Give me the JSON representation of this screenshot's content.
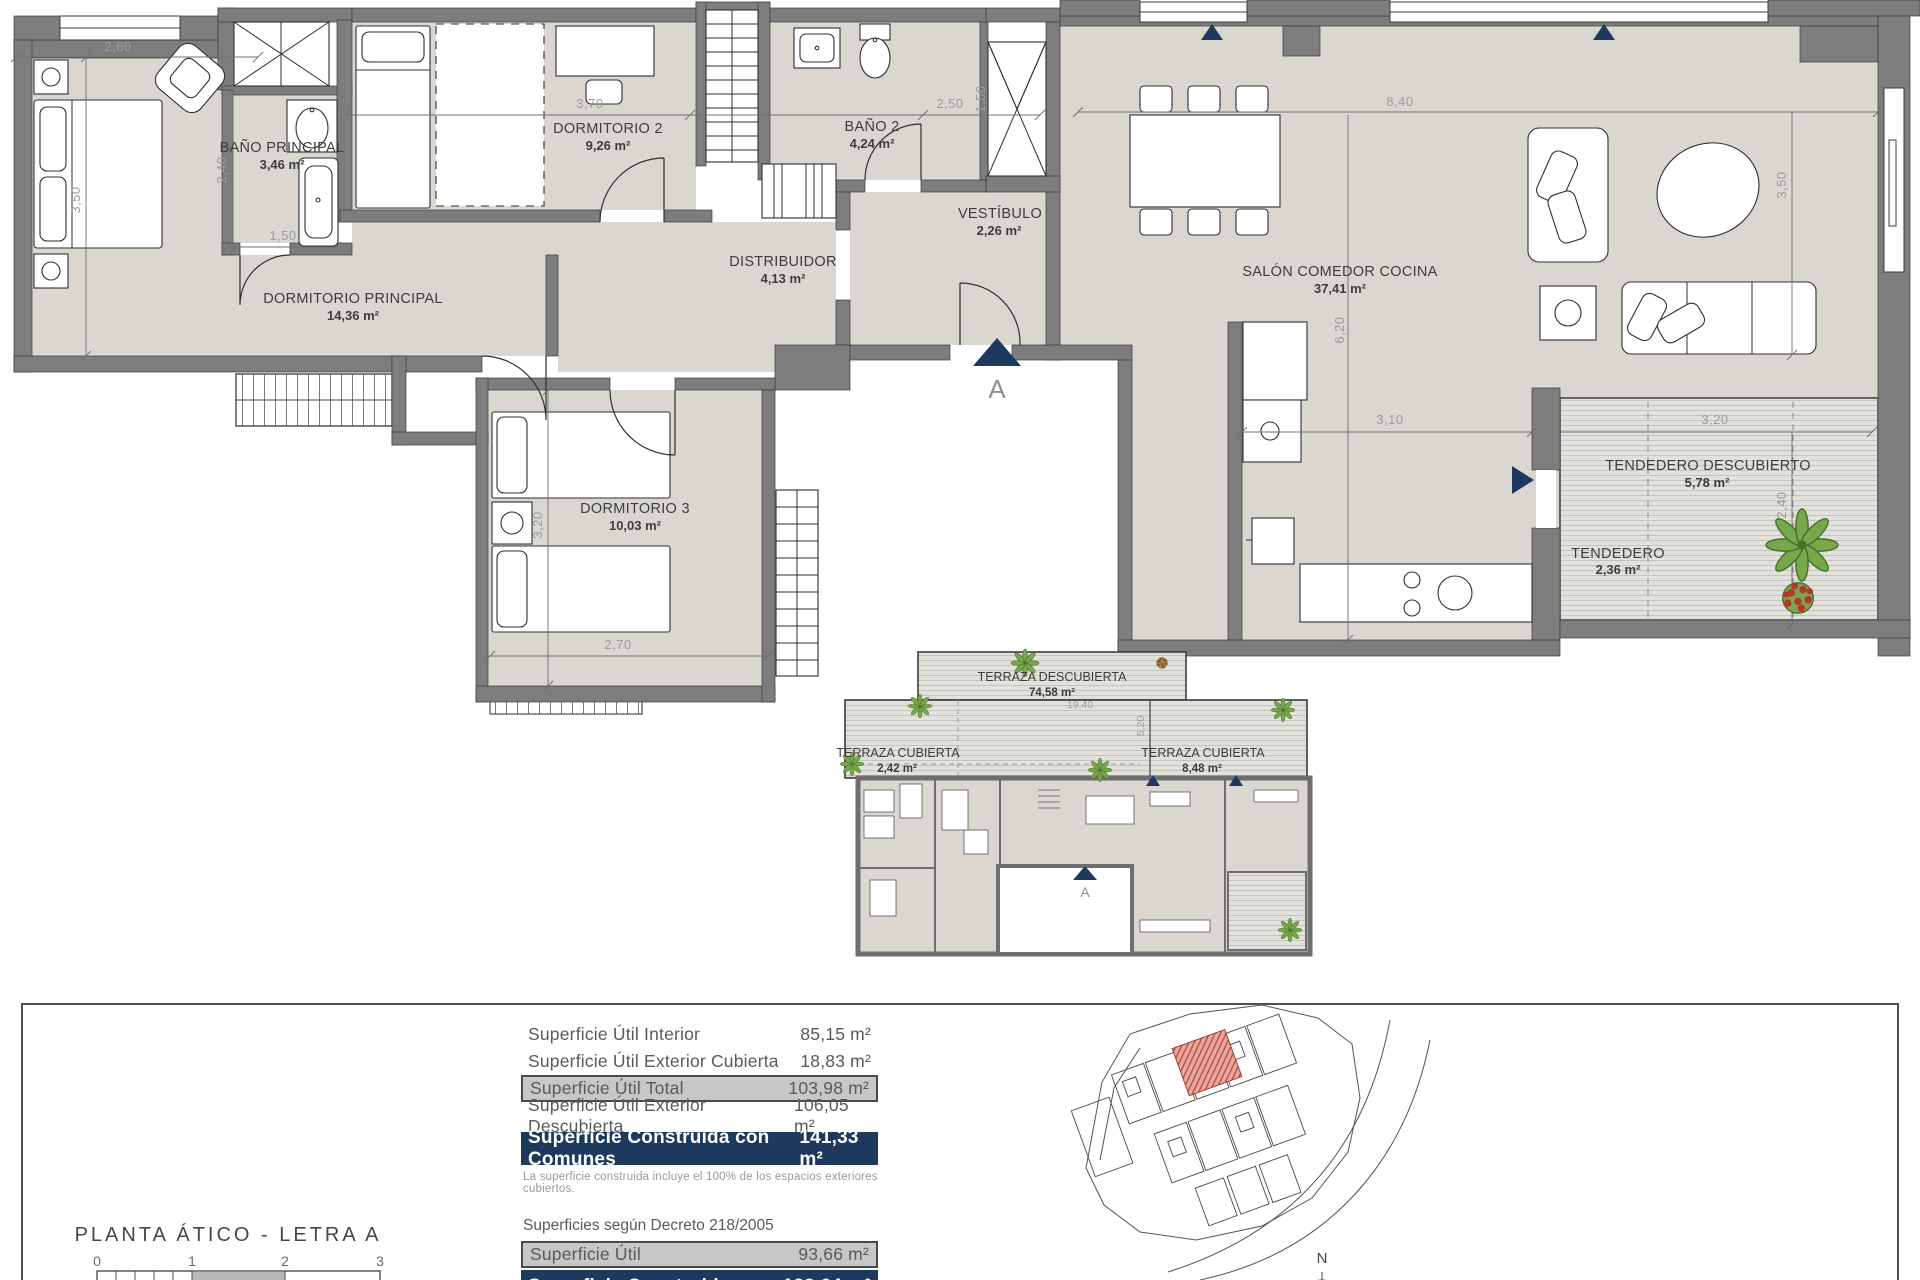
{
  "plan": {
    "rooms": [
      {
        "name": "DORMITORIO PRINCIPAL",
        "area": "14,36 m²"
      },
      {
        "name": "BAÑO PRINCIPAL",
        "area": "3,46 m²"
      },
      {
        "name": "DORMITORIO 2",
        "area": "9,26 m²"
      },
      {
        "name": "BAÑO 2",
        "area": "4,24 m²"
      },
      {
        "name": "VESTÍBULO",
        "area": "2,26 m²"
      },
      {
        "name": "DISTRIBUIDOR",
        "area": "4,13 m²"
      },
      {
        "name": "SALÓN COMEDOR COCINA",
        "area": "37,41 m²"
      },
      {
        "name": "DORMITORIO 3",
        "area": "10,03 m²"
      },
      {
        "name": "TENDEDERO DESCUBIERTO",
        "area": "5,78 m²"
      },
      {
        "name": "TENDEDERO",
        "area": "2,36 m²"
      }
    ],
    "dims": {
      "w260": "2,60",
      "h350": "3,50",
      "h240": "2,40",
      "w150": "1,50",
      "w370": "3,70",
      "w250": "2,50",
      "h150": "1,50",
      "w840": "8,40",
      "h350b": "3,50",
      "h620": "6,20",
      "w310": "3,10",
      "w320": "3,20",
      "h240b": "2,40",
      "h320": "3,20",
      "w270": "2,70"
    },
    "section_marker": "A"
  },
  "overview": {
    "rooms": [
      {
        "name": "TERRAZA DESCUBIERTA",
        "area": "74,58 m²"
      },
      {
        "name": "TERRAZA CUBIERTA",
        "area": "2,42 m²"
      },
      {
        "name": "TERRAZA CUBIERTA",
        "area": "8,48 m²"
      }
    ],
    "dims": {
      "w1940": "19,40",
      "h520": "5,20"
    },
    "section_marker": "A"
  },
  "footer": {
    "title": "PLANTA ÁTICO - LETRA A",
    "scale": {
      "t0": "0",
      "t1": "1",
      "t2": "2",
      "t3": "3"
    },
    "areas": {
      "r1_label": "Superficie Útil Interior",
      "r1_value": "85,15 m²",
      "r2_label": "Superficie Útil Exterior Cubierta",
      "r2_value": "18,83 m²",
      "r3_label": "Superficie Útil Total",
      "r3_value": "103,98 m²",
      "r4_label": "Superficie Útil Exterior Descubierta",
      "r4_value": "106,05 m²",
      "r5_label": "Superficie Construida con Comunes",
      "r5_value": "141,33 m²",
      "note": "La superficie construida incluye el 100% de los espacios exteriores cubiertos."
    },
    "decree": {
      "title": "Superficies según Decreto 218/2005",
      "r1_label": "Superficie Útil",
      "r1_value": "93,66 m²",
      "r2_label": "Superficie Construida",
      "r2_value": "133,64 m²"
    },
    "compass": "N"
  },
  "colors": {
    "accent_navy": "#1d3a5e",
    "row_gray": "#c7c7c7",
    "unit_red": "#b44a3c",
    "floor": "#d9d7d0"
  }
}
